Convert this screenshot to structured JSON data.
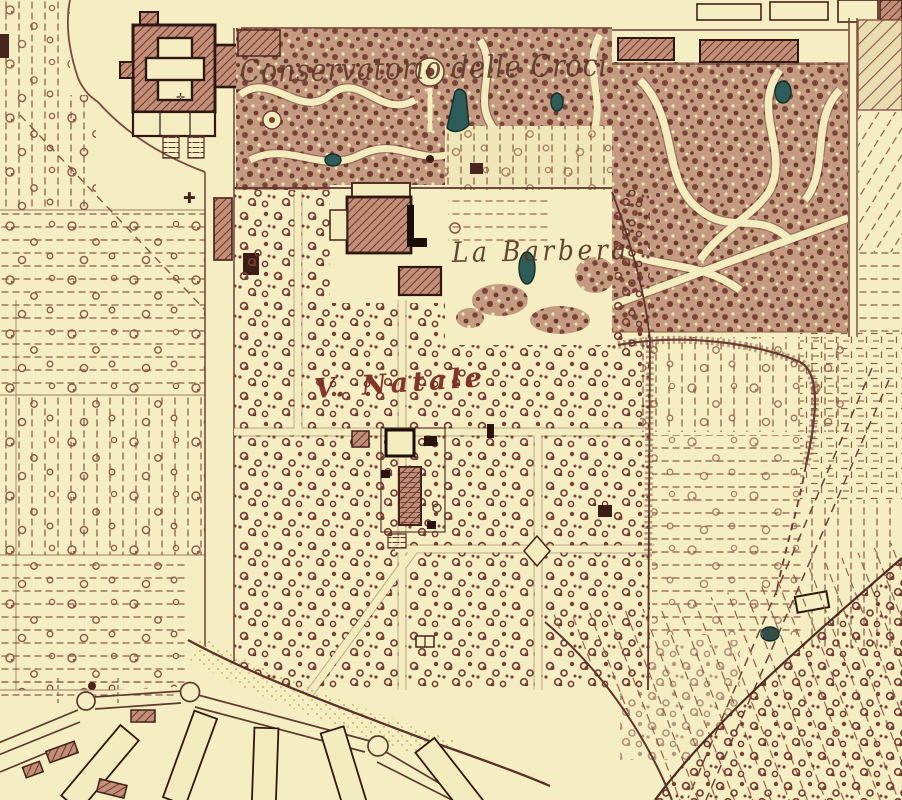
{
  "map": {
    "labels": {
      "conservatorio": {
        "text": "Conservatorio delle Croci"
      },
      "la_barbera": {
        "text": "La Barbera"
      },
      "v_natale": {
        "text": "V. Natale"
      }
    },
    "markers": {
      "road_cross": {
        "glyph": "✚"
      },
      "courtyard_cross": {
        "glyph": "✛"
      }
    },
    "colors": {
      "paper": "#f5eec3",
      "ink": "#6e3f33",
      "ink_dark": "#2f1813",
      "building_hatch": "#c18f77",
      "garden_mottle": "#c49b80",
      "field_dash": "#8a5d45",
      "water": "#2e5c59",
      "water_outline": "#14302d",
      "script_red": "#7d2d22"
    }
  }
}
